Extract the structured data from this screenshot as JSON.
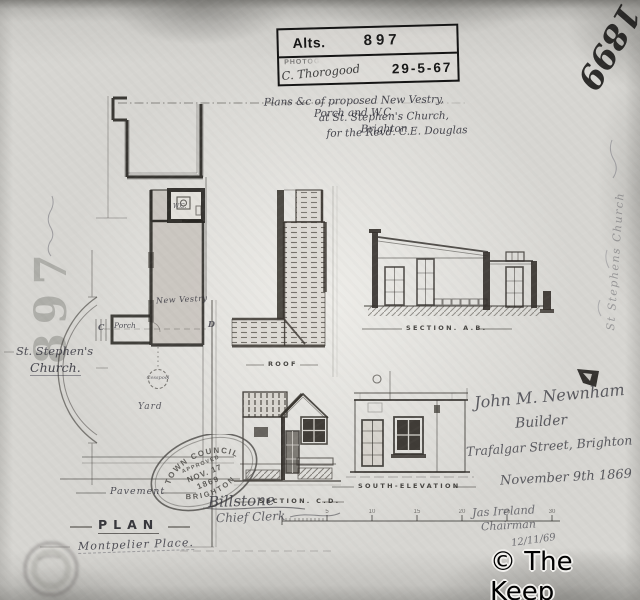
{
  "stamp_box": {
    "alts_label": "Alts.",
    "alts_number": "897",
    "photo_label": "PHOTOG",
    "signature": "C. Thorogood",
    "date": "29-5-67"
  },
  "title_block": {
    "line1": "Plans &c of proposed New Vestry, Porch and W.C.",
    "line2": "at St. Stephen's Church, Brighton",
    "line3": "for the Revd. C.E. Douglas"
  },
  "corner_year": "1899",
  "margin_note": "St Stephens Church",
  "left_margin": {
    "stencil_number": "897",
    "church_line1": "St. Stephen's",
    "church_line2": "Church."
  },
  "plan": {
    "labels": {
      "new_vestry": "New Vestry",
      "porch": "Porch",
      "wc": "W.C.",
      "yard": "Yard",
      "cesspool": "Cesspool",
      "pavement": "Pavement",
      "plan_title": "PLAN",
      "street": "Montpelier Place.",
      "marker_c": "C",
      "marker_d": "D"
    }
  },
  "captions": {
    "roof": "ROOF",
    "section_ab": "SECTION. A.B.",
    "section_cd": "SECTION. C.D.",
    "south_elevation": "SOUTH-ELEVATION"
  },
  "council_stamp": {
    "top": "TOWN COUNCIL",
    "approved": "APPROVED",
    "date": "NOV. 17",
    "year": "1869",
    "bottom": "BRIGHTON"
  },
  "signatures": {
    "clerk_name": "Billstone",
    "clerk_title": "Chief Clerk"
  },
  "builder_block": {
    "name": "John M. Newnham",
    "role": "Builder",
    "address": "Trafalgar Street, Brighton",
    "date": "November 9th 1869"
  },
  "chairman_block": {
    "name": "Jas Ireland",
    "role": "Chairman",
    "date": "12/11/69"
  },
  "scale_bar": {
    "ticks": [
      "5",
      "10",
      "15",
      "20",
      "25",
      "30"
    ]
  },
  "watermark": "© The Keep"
}
